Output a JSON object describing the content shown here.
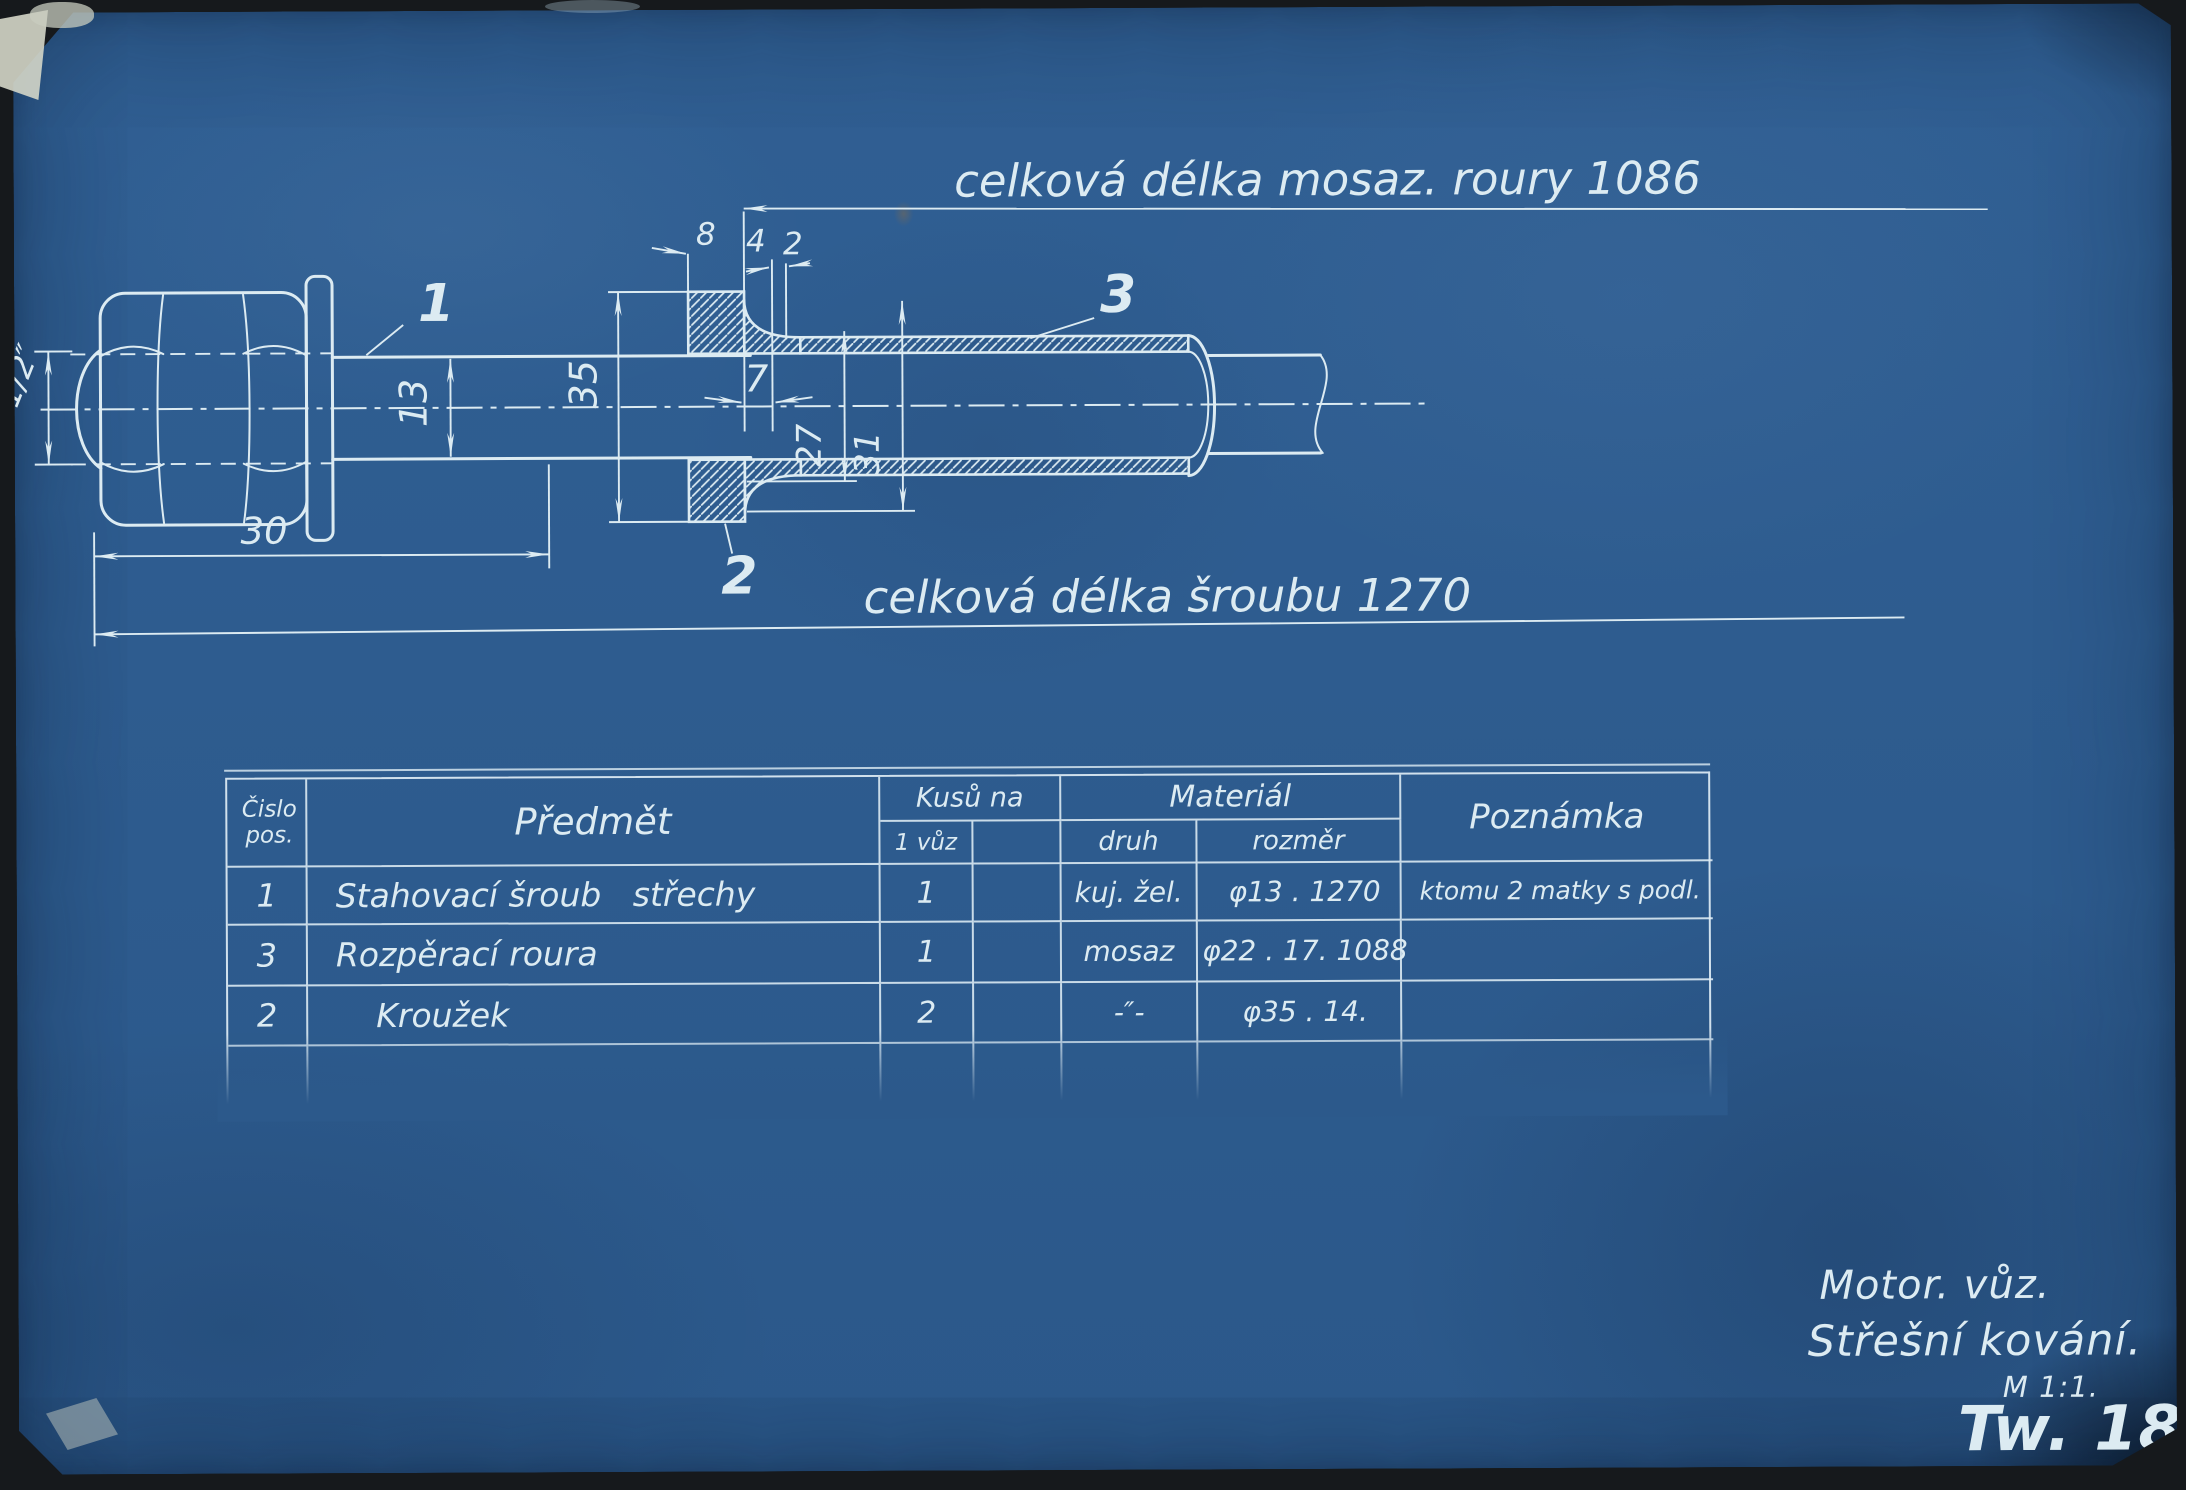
{
  "drawing": {
    "dim_tube_length": "celková délka mosaz. roury 1086",
    "dim_screw_length": "celková délka šroubu 1270",
    "dim_thread": "1/2″",
    "dim_nut_width": "30",
    "dim_shaft_dia": "13",
    "dim_ring_od": "35",
    "dim_8": "8",
    "dim_4": "4",
    "dim_2": "2",
    "dim_7": "7",
    "dim_flare_id": "27",
    "dim_flare_od": "31",
    "label_screw": "1",
    "label_ring": "2",
    "label_tube": "3"
  },
  "table": {
    "headers": {
      "pos_line1": "Čislo",
      "pos_line2": "pos.",
      "item": "Předmět",
      "qty_group": "Kusů na",
      "qty_sub": "1 vůz",
      "material_group": "Materiál",
      "material_kind": "druh",
      "material_size": "rozměr",
      "note": "Poznámka"
    },
    "rows": [
      {
        "pos": "1",
        "item": "Stahovací šroub   střechy",
        "qty": "1",
        "kind": "kuj. žel.",
        "size": "φ13 . 1270",
        "note": "ktomu 2 matky s podl."
      },
      {
        "pos": "3",
        "item": "Rozpěrací roura",
        "qty": "1",
        "kind": "mosaz",
        "size": "φ22 . 17. 1088",
        "note": ""
      },
      {
        "pos": "2",
        "item": "Kroužek",
        "qty": "2",
        "kind": "-″-",
        "size": "φ35 . 14.",
        "note": ""
      }
    ]
  },
  "title_block": {
    "line1": "Motor. vůz.",
    "line2": "Střešní kování.",
    "scale": "M 1:1.",
    "number": "Tw. 183"
  },
  "colors": {
    "paper_blue": "#2d5c8f",
    "line_white": "#dcebf2",
    "surround_black": "#16191c"
  }
}
